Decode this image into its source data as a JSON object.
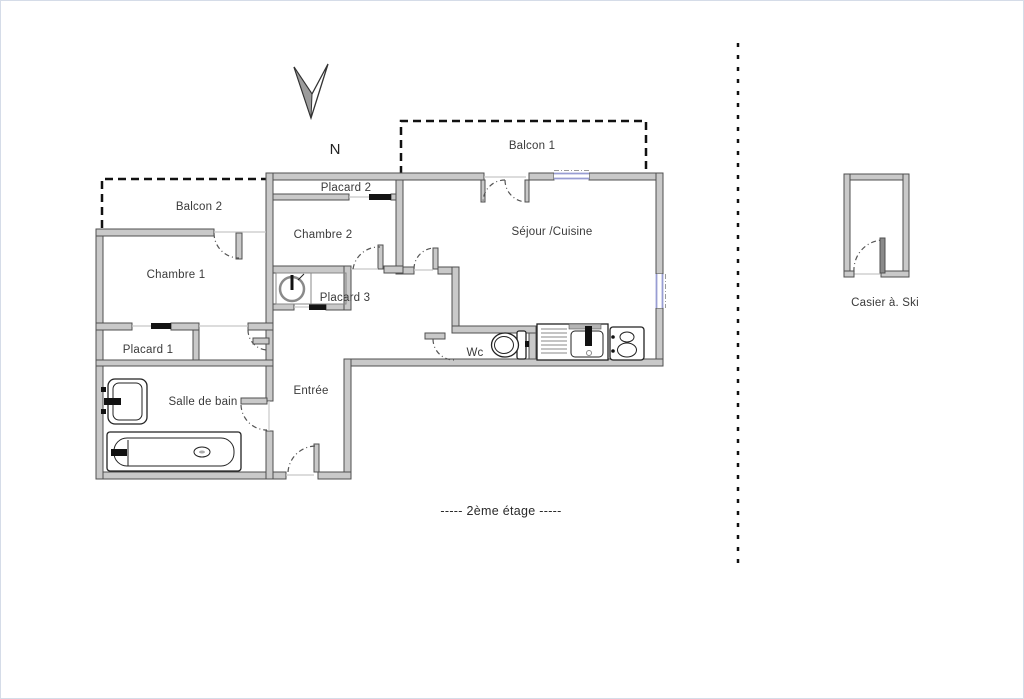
{
  "plan": {
    "north_label": "N",
    "floor_caption": "-----  2ème étage  -----",
    "rooms": {
      "balcon1": "Balcon 1",
      "balcon2": "Balcon 2",
      "placard2": "Placard 2",
      "chambre2": "Chambre 2",
      "sejour": "Séjour /Cuisine",
      "chambre1": "Chambre 1",
      "placard3": "Placard 3",
      "placard1": "Placard 1",
      "wc": "Wc",
      "salle_de_bain": "Salle de bain",
      "entree": "Entrée",
      "casier": "Casier à. Ski"
    },
    "colors": {
      "wall_fill": "#c9c9c9",
      "wall_stroke": "#4f4f4f",
      "window": "#989dd3",
      "dash": "#111111"
    }
  }
}
